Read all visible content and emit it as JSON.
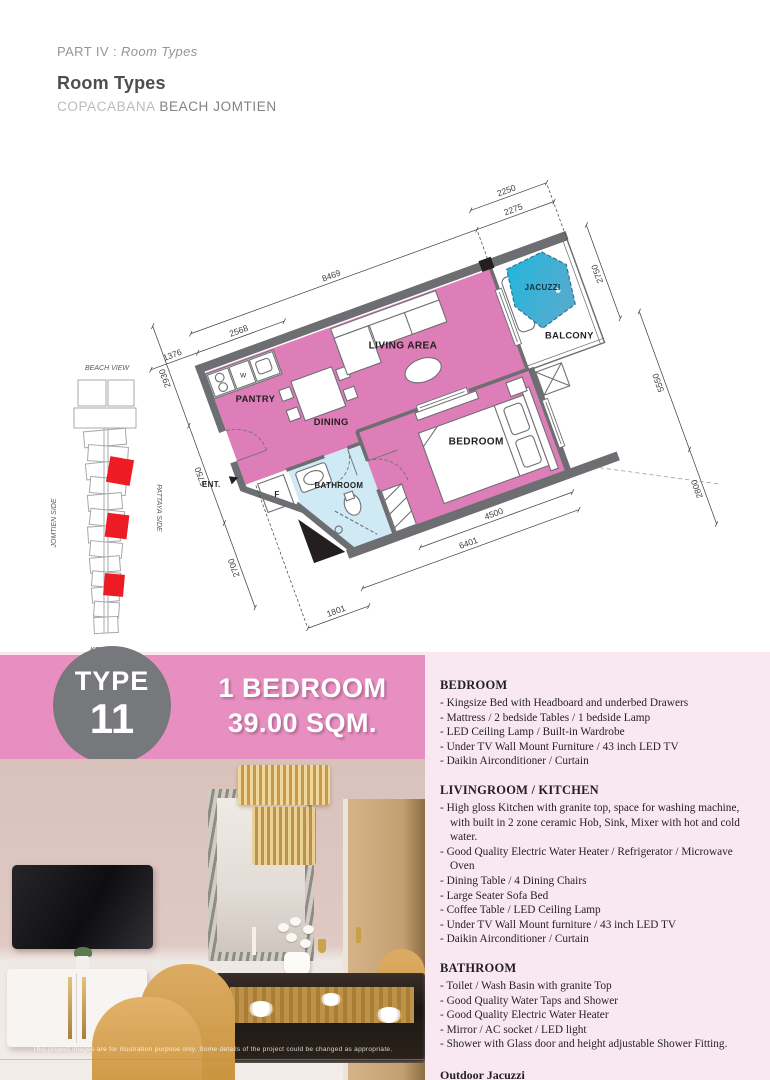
{
  "header": {
    "part_prefix": "PART IV : ",
    "part_italic": "Room Types",
    "title": "Room Types",
    "brand_light": "COPACABANA",
    "brand_dark": "BEACH JOMTIEN"
  },
  "floorplan": {
    "rooms": {
      "living": "LIVING AREA",
      "dining": "DINING",
      "pantry": "PANTRY",
      "bedroom": "BEDROOM",
      "bathroom": "BATHROOM",
      "balcony": "BALCONY",
      "jacuzzi": "JACUZZI",
      "entrance": "ENT.",
      "fridge": "F",
      "washer": "W"
    },
    "dims": {
      "top_outer": "2250",
      "top_main": "8469",
      "top_living": "2275",
      "top_pantry": "2568",
      "top_left": "1376",
      "right_balcony": "2750",
      "right_mid": "5550",
      "right_low": "2800",
      "left_top": "2930",
      "left_mid": "5750",
      "left_low": "2700",
      "bottom_right": "4500",
      "bottom_mid": "6401",
      "bottom_left": "1801"
    },
    "colors": {
      "room_pink": "#dd7eb8",
      "bath_blue": "#cfe9f5",
      "wall_gray": "#6d6e71",
      "jacuzzi_from": "#1fb7dc",
      "jacuzzi_to": "#62a8cc"
    }
  },
  "keyplan": {
    "beach_view": "BEACH VIEW",
    "key_plan": "KEY PLAN",
    "jomtien_side": "JOMTIEN SIDE",
    "pattaya_side": "PATTAYA SIDE",
    "highlight_color": "#ed1c24"
  },
  "type_banner": {
    "type_label": "TYPE",
    "type_number": "11",
    "line1": "1 BEDROOM",
    "line2": "39.00 SQM.",
    "band_color": "#e78fc0",
    "circle_color": "#77787b"
  },
  "photo": {
    "disclaimer": "This project images are for illustration purpose only. Some details of the project could be changed as appropriate."
  },
  "specs": {
    "sections": [
      {
        "heading": "BEDROOM",
        "items": [
          "- Kingsize Bed with Headboard and underbed Drawers",
          "- Mattress / 2 bedside Tables / 1 bedside Lamp",
          "- LED Ceiling Lamp / Built-in Wardrobe",
          "- Under TV Wall Mount Furniture / 43 inch LED TV",
          "- Daikin Airconditioner / Curtain"
        ]
      },
      {
        "heading": "LIVINGROOM / KITCHEN",
        "items": [
          "- High gloss Kitchen with granite top, space for washing machine, with built in 2 zone ceramic Hob, Sink, Mixer with hot and cold water.",
          "- Good Quality Electric Water Heater / Refrigerator / Microwave Oven",
          "- Dining Table / 4 Dining Chairs",
          "- Large Seater Sofa Bed",
          "- Coffee Table / LED Ceiling Lamp",
          "- Under TV Wall Mount furniture / 43 inch LED TV",
          "- Daikin Airconditioner / Curtain"
        ]
      },
      {
        "heading": "BATHROOM",
        "items": [
          "- Toilet / Wash Basin with granite Top",
          "- Good Quality Water Taps and Shower",
          "- Good Quality Electric Water Heater",
          "- Mirror / AC socket / LED light",
          "- Shower with Glass door and height adjustable Shower Fitting."
        ]
      }
    ],
    "footnote": "Outdoor Jacuzzi"
  }
}
